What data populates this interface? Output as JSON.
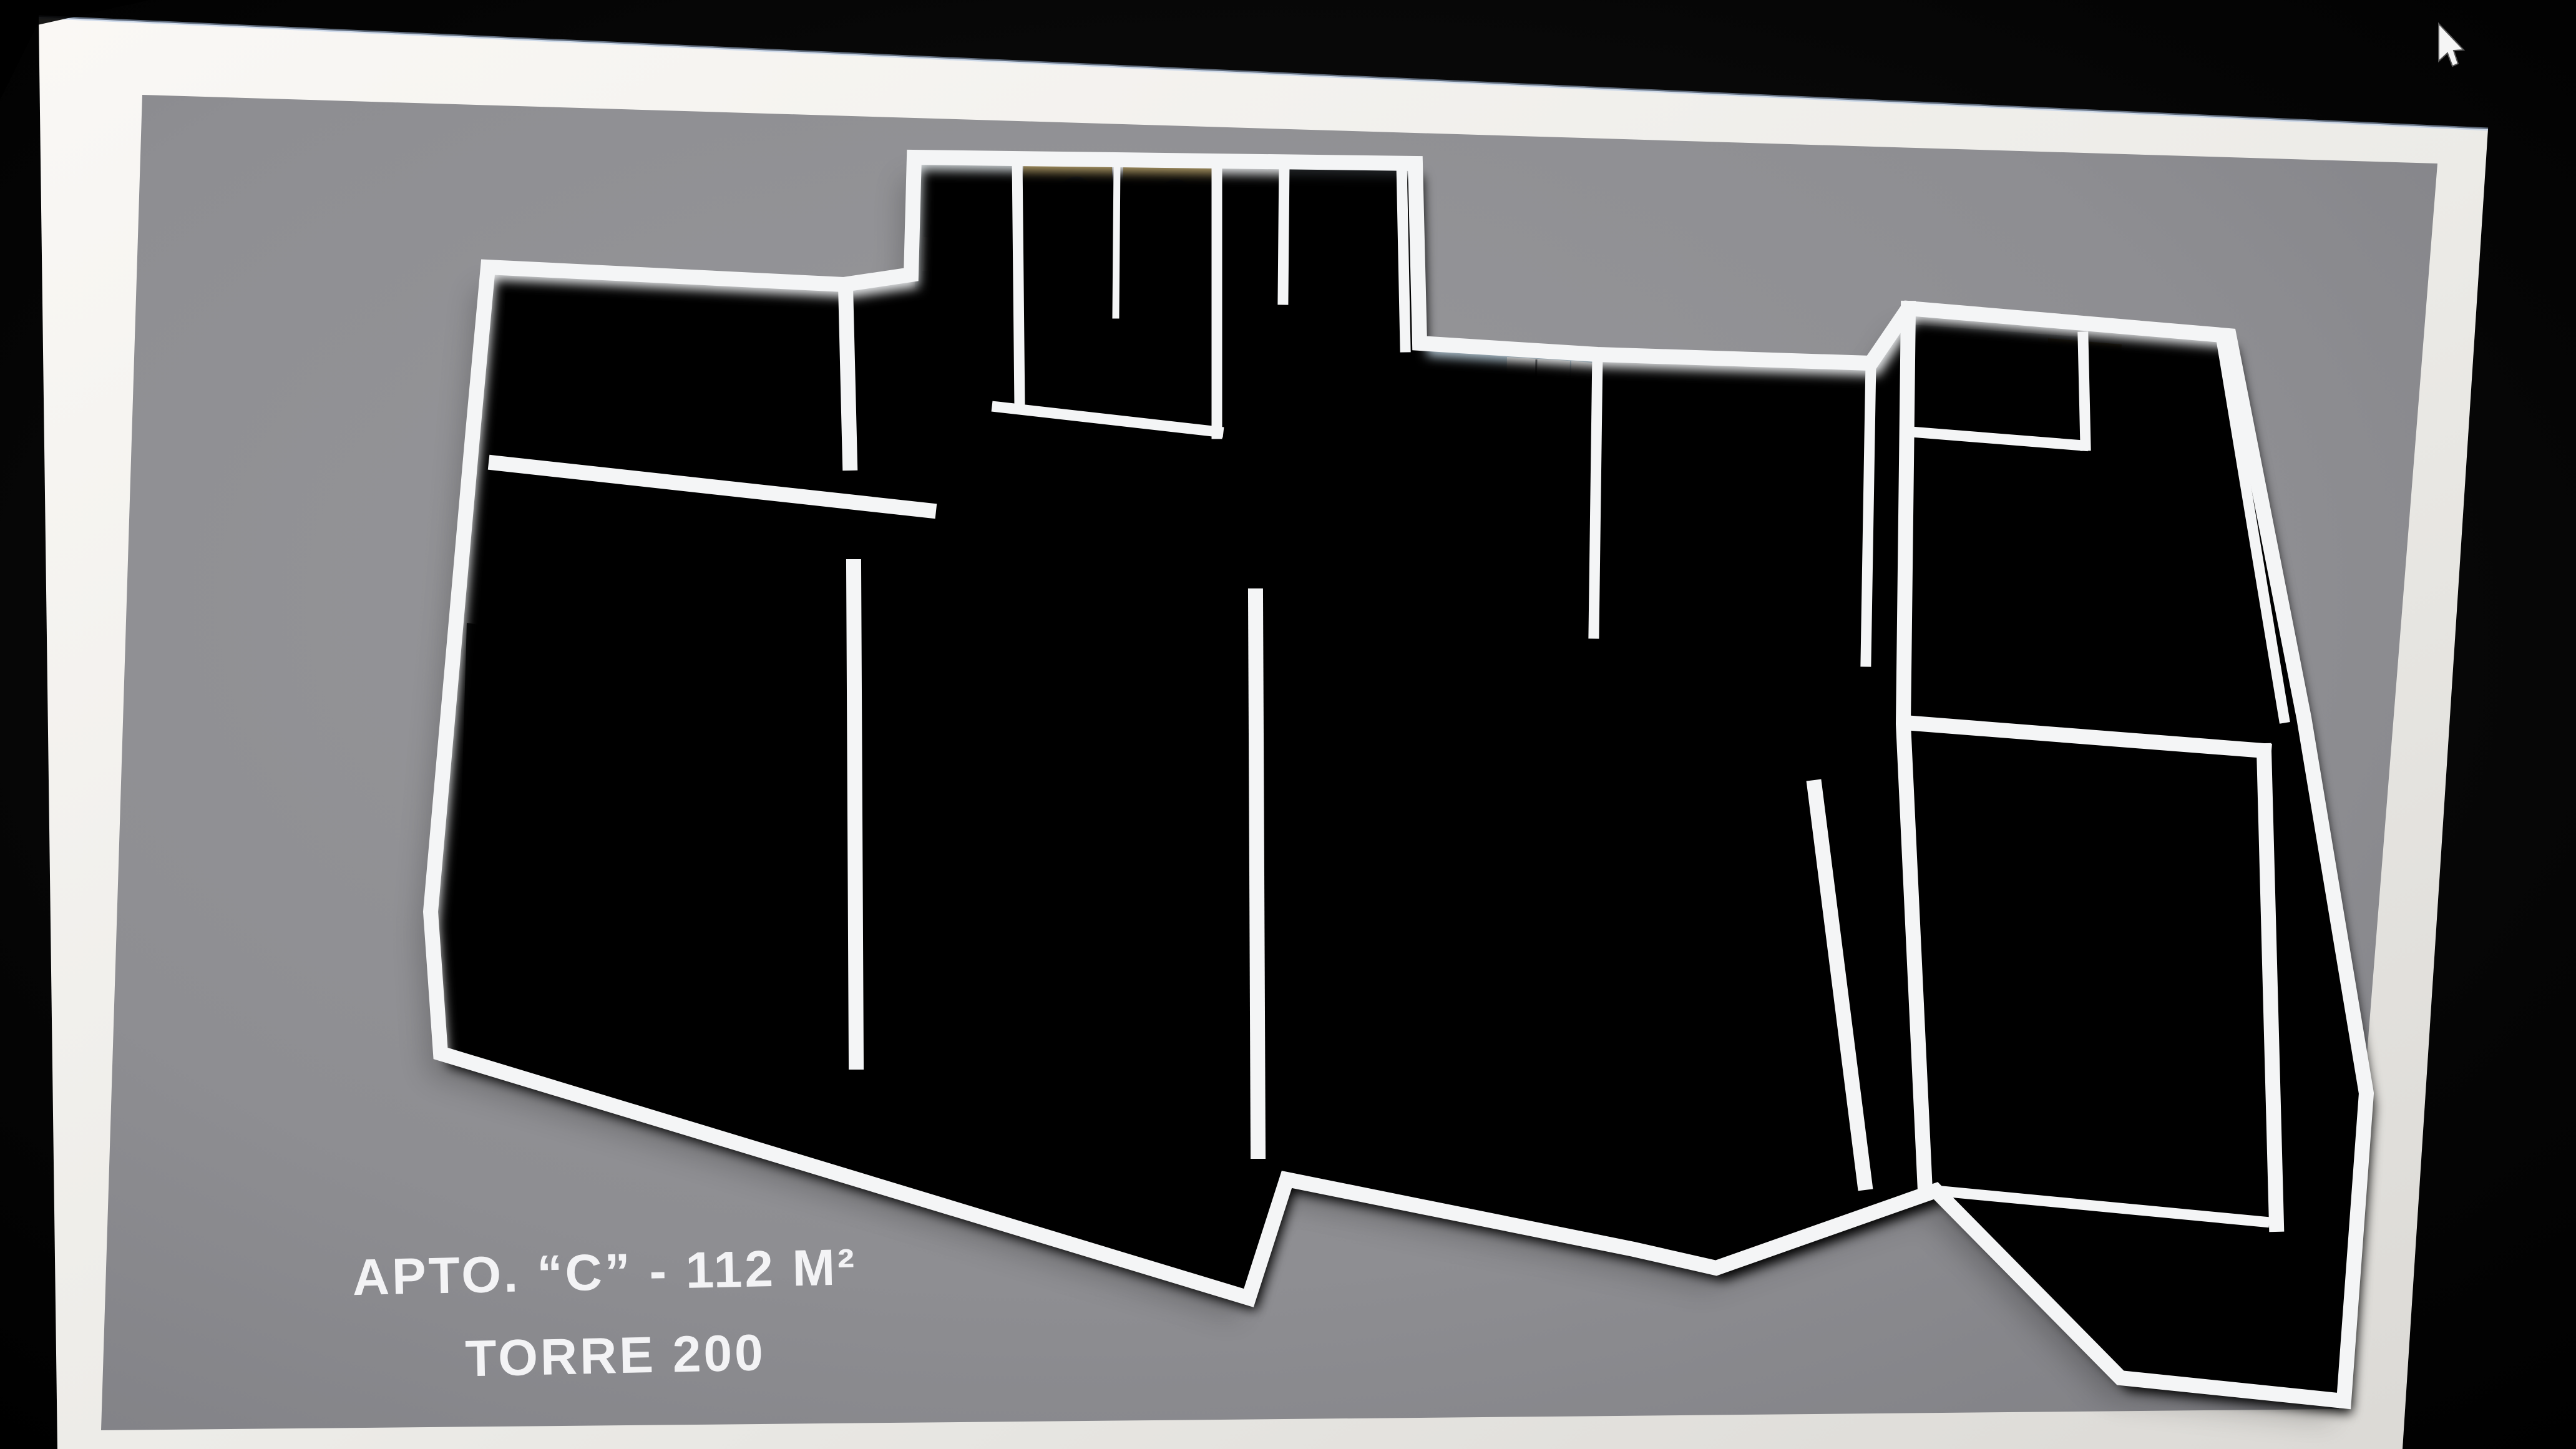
{
  "caption": {
    "line1": "APTO. “C” - 112 M²",
    "line2": "TORRE 200"
  },
  "cursor": "arrow-cursor",
  "palette": {
    "background": "#050505",
    "frame": "#efede9",
    "slide": "#929296",
    "wall": "#f4f5f6",
    "dark": "#33363a",
    "navy": "#16222c",
    "bedblue": "#c3d5e3",
    "wood": "#a57a35",
    "tan": "#b5a06b",
    "beige": "#d8cfbf",
    "brown": "#4a3a28",
    "green": "#5d8030",
    "red": "#c23830",
    "floorblue": "#b9cedb",
    "caption_text": "#f3f3f5"
  },
  "floor_plan": {
    "type": "3d-apartment-render",
    "rooms": [
      {
        "name": "walk-in-closet",
        "furniture": [
          "dark-wardrobe",
          "picture-frame"
        ]
      },
      {
        "name": "master-bedroom",
        "furniture": [
          "double-bed",
          "black-headboard",
          "nightstands",
          "open-closet-doors"
        ]
      },
      {
        "name": "bathrooms",
        "furniture": [
          "shower-stall-1",
          "shower-stall-2",
          "blue-bathtub",
          "shelving-cabinet"
        ]
      },
      {
        "name": "second-bedroom",
        "furniture": [
          "wardrobe",
          "double-bed",
          "table-lamp"
        ]
      },
      {
        "name": "entry-hall",
        "furniture": [
          "wood-threshold"
        ]
      },
      {
        "name": "kitchen",
        "furniture": [
          "stove",
          "wood-counter",
          "fridge",
          "island-sink",
          "bar-stools"
        ]
      },
      {
        "name": "living-room",
        "furniture": [
          "navy-rug",
          "coffee-table",
          "white-sofa",
          "armchair",
          "tv-console"
        ]
      },
      {
        "name": "dining-room",
        "furniture": [
          "dining-table",
          "six-chairs",
          "red-flowers",
          "green-centerpiece"
        ]
      },
      {
        "name": "right-bathroom",
        "furniture": [
          "toilet",
          "vanity",
          "shower-head",
          "tan-wall"
        ]
      },
      {
        "name": "right-bedroom",
        "furniture": [
          "double-bed",
          "brown-headboard",
          "round-lamps",
          "wardrobe"
        ]
      },
      {
        "name": "terrace-left",
        "furniture": [
          "glass-railing",
          "tile-floor"
        ]
      },
      {
        "name": "balcony-center",
        "furniture": [
          "plant-bush",
          "beige-tiles",
          "glass-railing"
        ]
      },
      {
        "name": "terrace-right",
        "furniture": [
          "railing"
        ]
      }
    ]
  }
}
